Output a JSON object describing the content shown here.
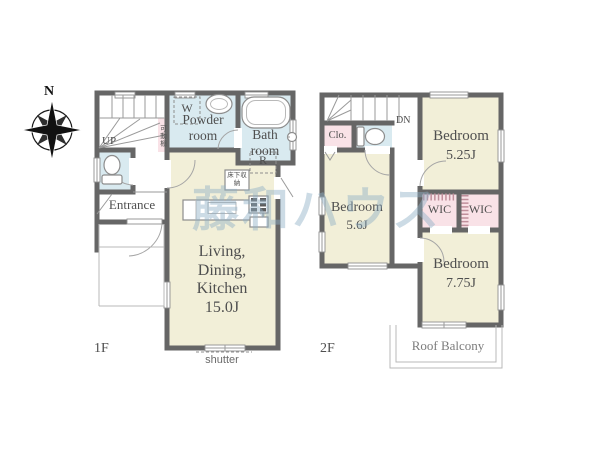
{
  "watermark": "藤和ハウス",
  "compass": {
    "north": "N"
  },
  "floor1": {
    "label": "1F",
    "stairs": "UP",
    "entrance": "Entrance",
    "powder_room": "Powder room",
    "bath_room": "Bath room",
    "washer": "W",
    "refrigerator": "R",
    "movable_shelf": "可動棚",
    "underfloor_storage": "床下収納",
    "ldk": {
      "line1": "Living,",
      "line2": "Dining,",
      "line3": "Kitchen",
      "line4": "15.0J"
    },
    "shutter": "shutter"
  },
  "floor2": {
    "label": "2F",
    "stairs": "DN",
    "closet": "Clo.",
    "bedroom_a": {
      "name": "Bedroom",
      "size": "5.25J"
    },
    "bedroom_b": {
      "name": "Bedroom",
      "size": "5.6J"
    },
    "bedroom_c": {
      "name": "Bedroom",
      "size": "7.75J"
    },
    "wic_left": "WIC",
    "wic_right": "WIC",
    "roof_balcony": "Roof Balcony"
  },
  "colors": {
    "wall": "#666666",
    "room_tatami": "#f2efd8",
    "room_wet": "#d9eaf0",
    "room_storage": "#f9e2e7",
    "watermark": "#8fb0c6"
  }
}
